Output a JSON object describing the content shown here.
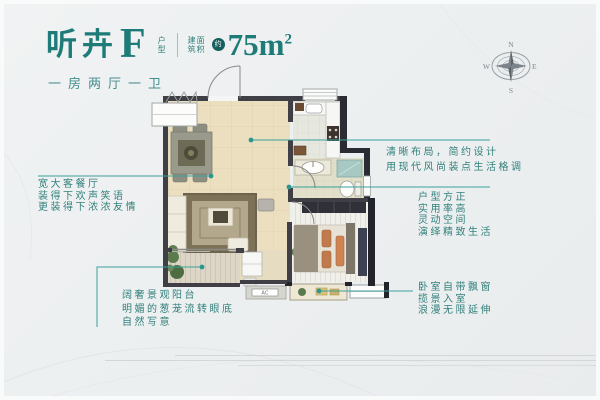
{
  "header": {
    "title": "听卉",
    "plan_letter": "F",
    "plan_label_chars": [
      "户",
      "型"
    ],
    "area_label_lines": [
      "建面",
      "筑积"
    ],
    "approx_badge": "约",
    "area_number": "75m",
    "area_sup": "2",
    "subtitle": "一房两厅一卫"
  },
  "compass": {
    "north": "N",
    "south": "S",
    "east": "E",
    "west": "W"
  },
  "notes": {
    "living": [
      "宽大客餐厅",
      "装得下欢声笑语",
      "更装得下浓浓友情"
    ],
    "balcony": [
      "阔奢景观阳台",
      "明媚的葱茏流转眼底",
      "自然写意"
    ],
    "layout": [
      "清晰布局，简约设计",
      "用现代风尚装点生活格调"
    ],
    "shape": [
      "户型方正",
      "实用率高",
      "灵动空间",
      "演绎精致生活"
    ],
    "bedroom": [
      "卧室自带飘窗",
      "揽景入室",
      "浪漫无限延伸"
    ]
  },
  "floorplan": {
    "ac_label": "AC"
  },
  "colors": {
    "accent_teal": "#1e7b78",
    "connector_teal": "#38a29c",
    "wall_dark": "#3f3f45",
    "floor_beige": "#ebdfc0"
  }
}
